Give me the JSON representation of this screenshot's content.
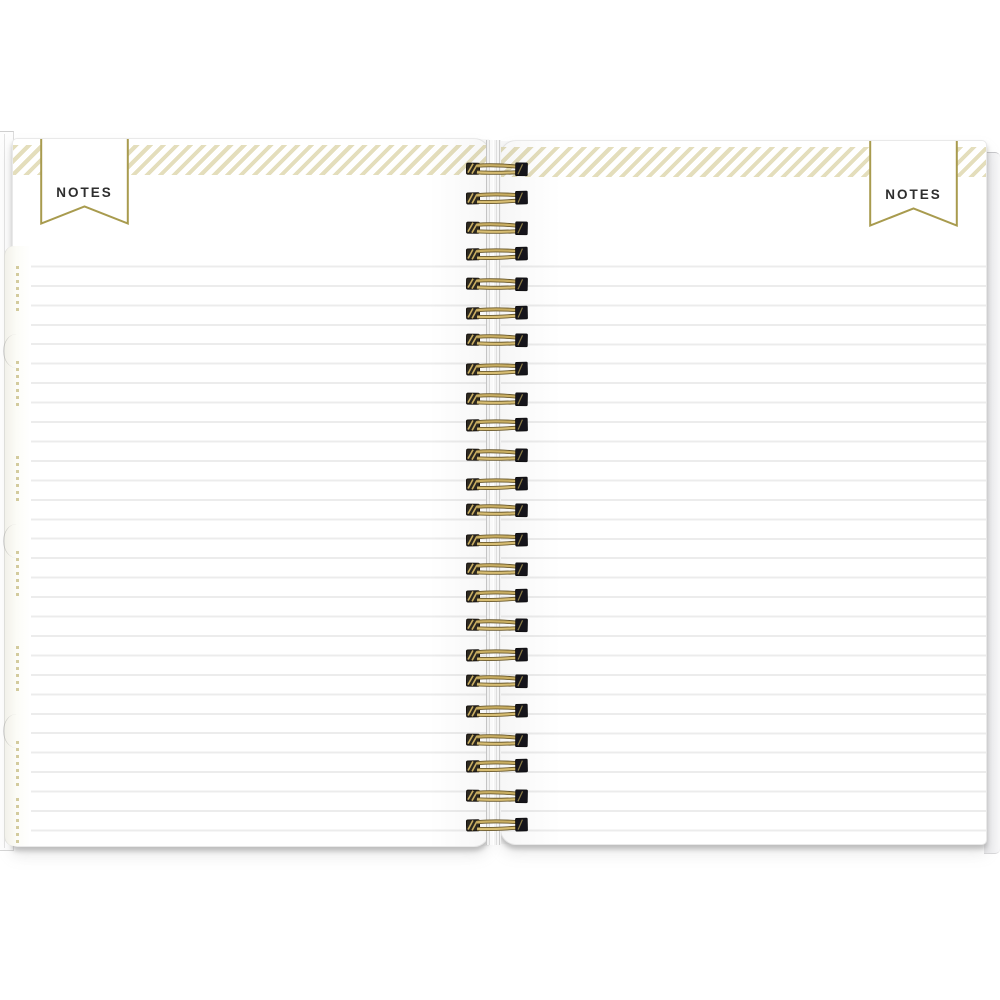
{
  "photo": {
    "description": "Open spiral-bound planner showing two blank lined Notes pages with gold wire binding and gold striped header bands",
    "left_page": {
      "banner_label": "NOTES"
    },
    "right_page": {
      "banner_label": "NOTES"
    },
    "binding": {
      "coil_count": 24,
      "wire_color": "#c9ae62",
      "wire_shadow_color": "#6b5a2e",
      "left_cap_color": "#2c2820",
      "right_cap_color": "#15141a"
    },
    "ruling": {
      "line_count": 31,
      "line_spacing_px": 19.45,
      "line_color": "#ececec"
    },
    "colors": {
      "stripe_gold": "#e1dab4",
      "banner_border_gold": "#a89b4e",
      "banner_text": "#2e2e2e",
      "page_white": "#ffffff",
      "tab_mark_gold": "#b2a355"
    }
  }
}
